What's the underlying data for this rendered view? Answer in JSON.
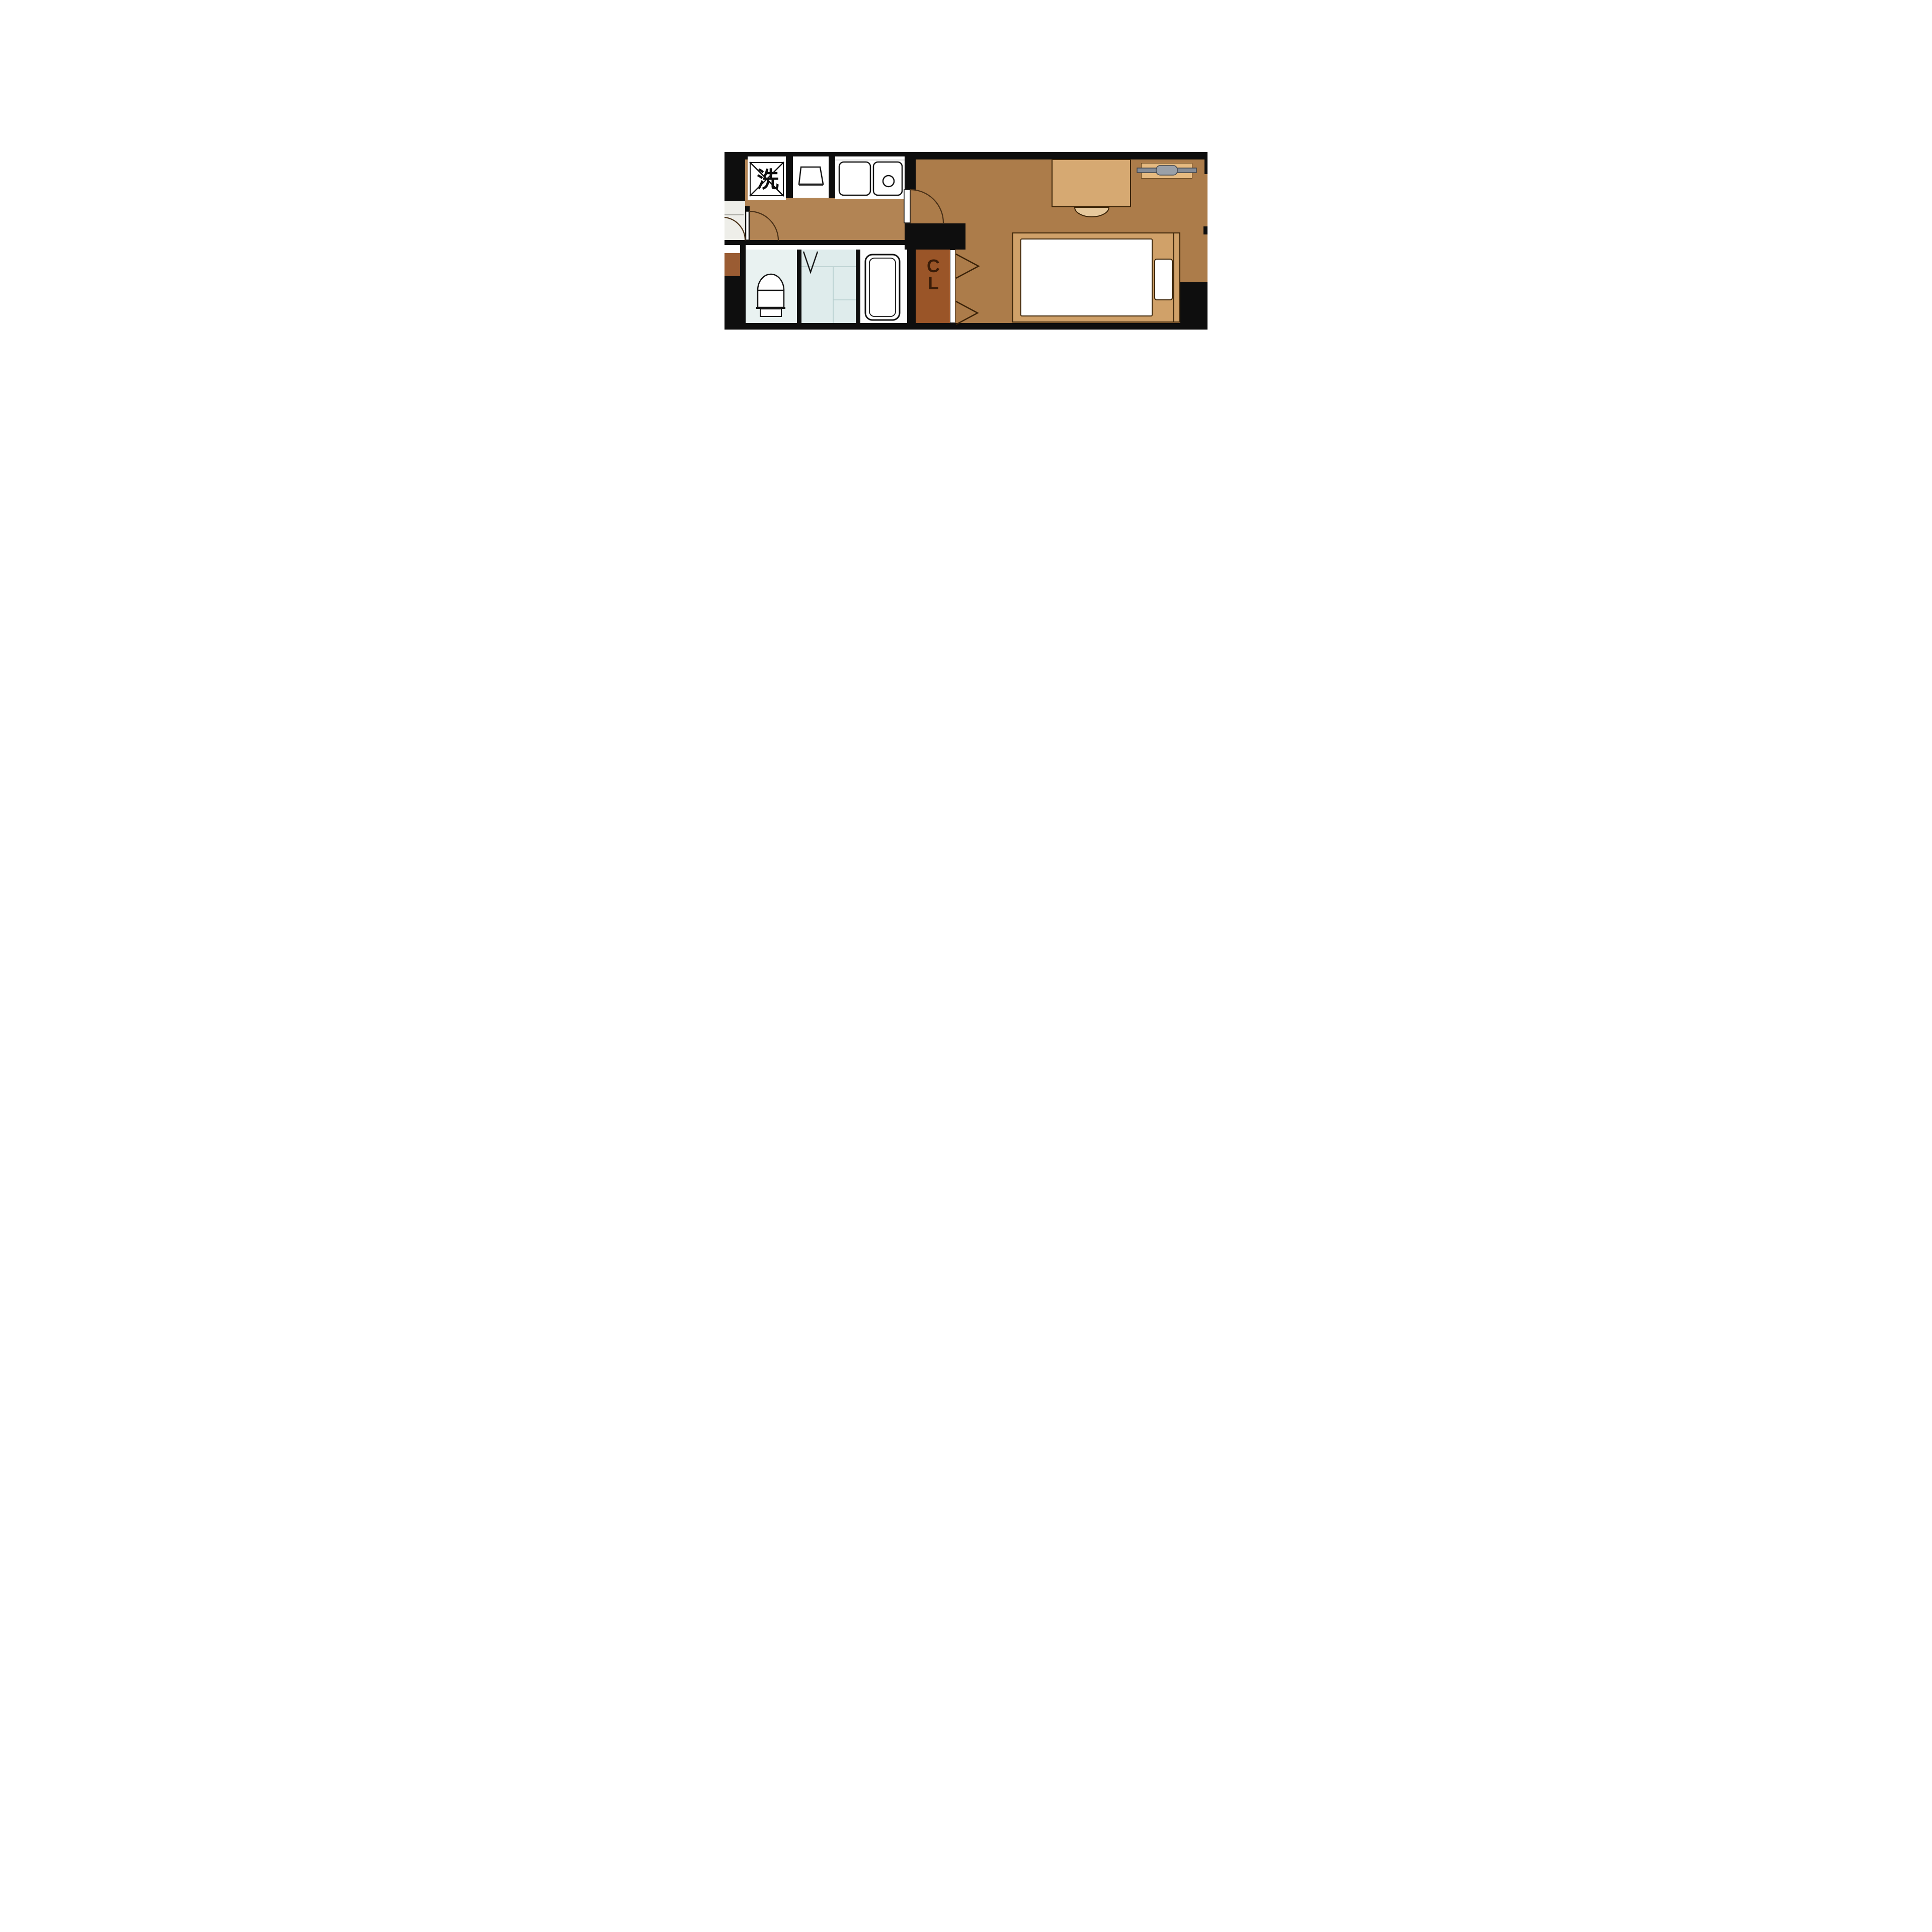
{
  "floorplan": {
    "kind": "japanese-1k-apartment-floor-plan",
    "labels": {
      "washing_machine": "洗",
      "meter_box": "B",
      "closet_line_1": "C",
      "closet_line_2": "L"
    },
    "rooms": [
      {
        "name": "entrance"
      },
      {
        "name": "hallway-kitchen"
      },
      {
        "name": "toilet-room"
      },
      {
        "name": "bathroom-tiled"
      },
      {
        "name": "bathtub-room"
      },
      {
        "name": "closet-CL"
      },
      {
        "name": "main-room"
      }
    ],
    "fixtures": [
      "washing-machine-space",
      "stove-space",
      "kitchen-sink",
      "stove-burner",
      "toilet",
      "bathtub",
      "shower-folding-door",
      "desk",
      "desk-chair",
      "bed",
      "mattress",
      "pillow",
      "air-conditioner",
      "meter-box",
      "closet-folding-doors",
      "entrance-door-swing",
      "hall-door-swing",
      "main-room-door-swing"
    ],
    "colors": {
      "wall": "#0e0e0e",
      "hallway": "#b28454",
      "main_room": "#ac7c4a",
      "entry": "#eeeee9",
      "toilet_room": "#e9f2f1",
      "bathroom": "#dfecec",
      "tub_room": "#fdfdfd",
      "closet": "#9a5528",
      "closet_letter": "#3a1c08",
      "meter_bg": "#9a5c33",
      "meter_letter": "#c0662e",
      "counter_white": "#ffffff",
      "mattress": "#ffffff",
      "furniture_tan": "#d0a169",
      "furniture_light": "#e6c89c",
      "furniture_border": "#3b2408",
      "desk_tan": "#d6a972",
      "ac_body": "#e6ba80",
      "ac_bar": "#868c96",
      "ac_lens": "#9aa0a8",
      "stroke_dark": "#141414",
      "door_arc": "#4a3118",
      "tile_line": "#b5cdcd",
      "entry_line": "#a8a8a2"
    }
  }
}
